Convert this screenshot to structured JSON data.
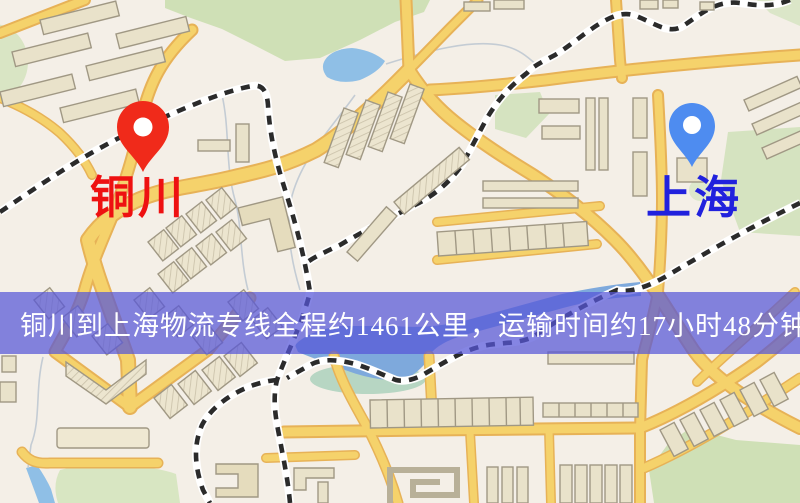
{
  "map": {
    "origin": {
      "name": "铜川",
      "marker": "red-location-pin",
      "marker_color": "#f02a1a",
      "label_color": "#ee1111"
    },
    "destination": {
      "name": "上海",
      "marker": "blue-location-pin",
      "marker_color": "#4e8cf0",
      "label_color": "#2121dd"
    }
  },
  "banner": {
    "text": "铜川到上海物流专线全程约1461公里，运输时间约17小时48分钟.",
    "background_color": "#5656d8",
    "opacity": 0.72,
    "text_color": "#ffffff"
  },
  "route": {
    "origin": "铜川",
    "destination": "上海",
    "distance_text": "约1461公里",
    "duration_text": "约17小时48分钟"
  },
  "palette": {
    "map_background": "#f4efe7",
    "road_fill": "#f5d26b",
    "road_border": "#e7b257",
    "water": "#8fbfe6",
    "park_green": "#cfe0b6",
    "building_fill": "#e9e2ca",
    "building_outline": "#a09884",
    "railway_dash": "#2b2b2b"
  }
}
